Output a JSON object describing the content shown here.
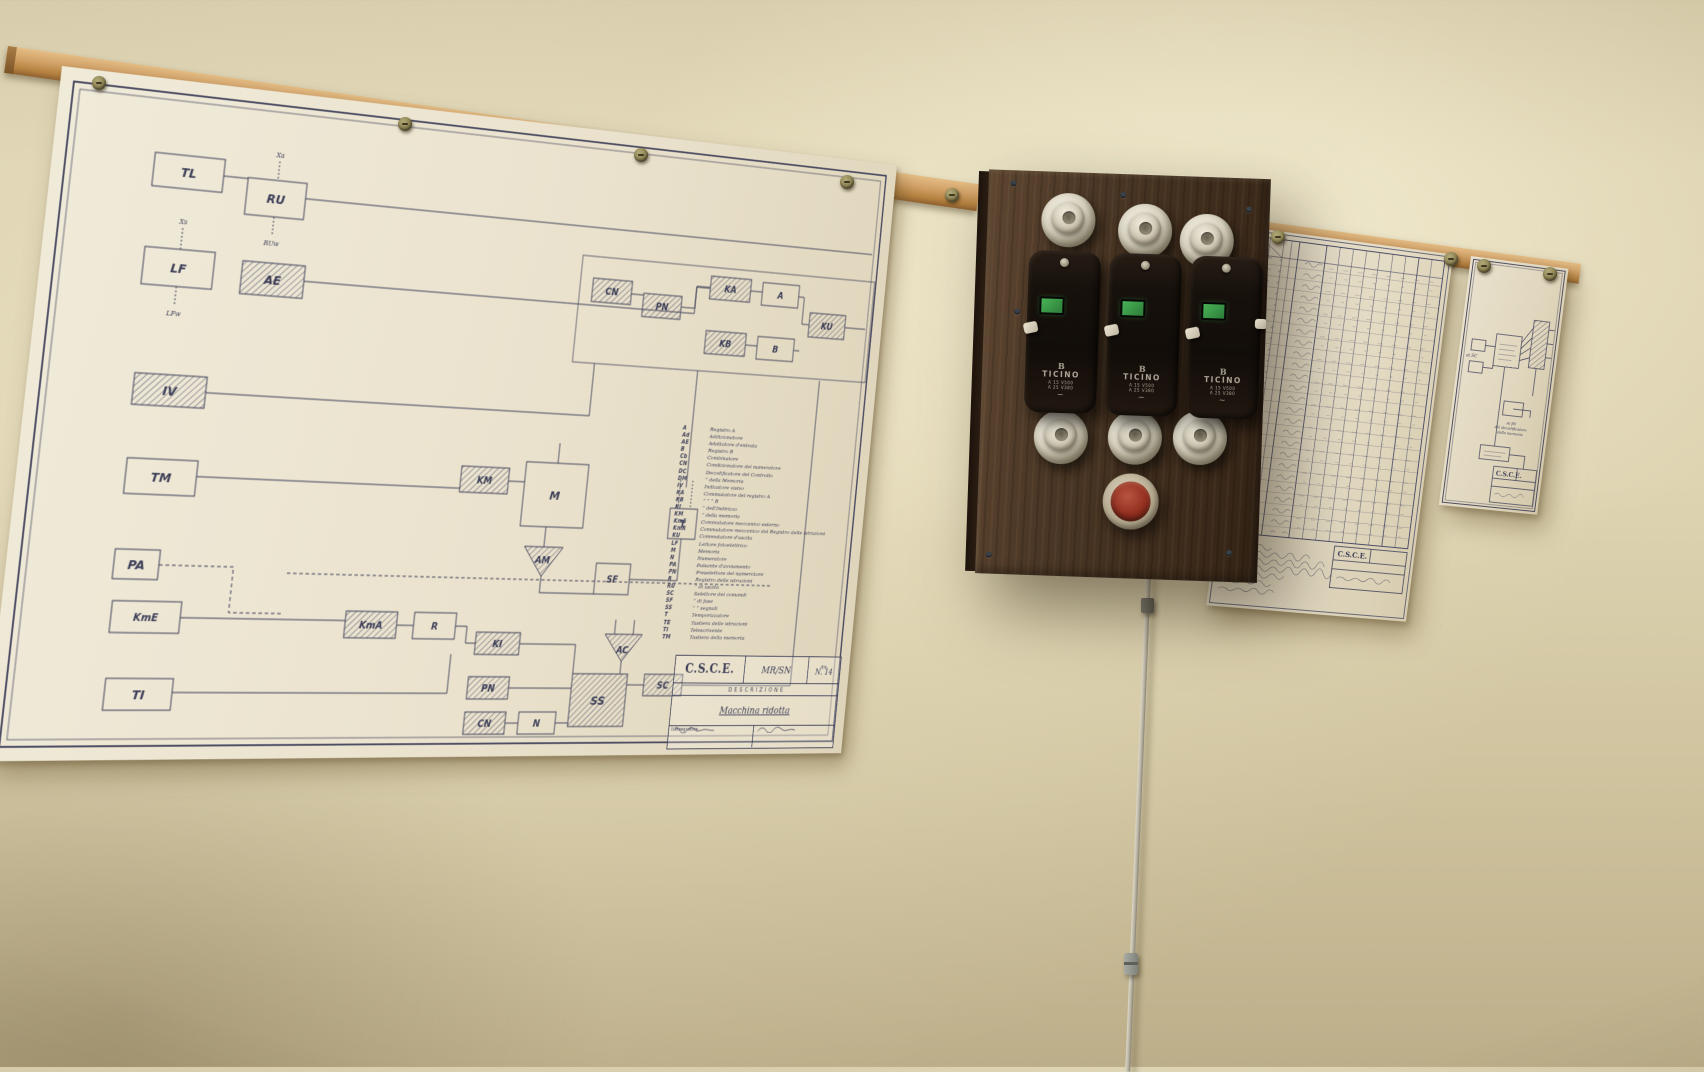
{
  "colors": {
    "wall": "#d8cdab",
    "paper": "#ece5d2",
    "ink": "#3c3e58",
    "rail_wood": "#c99a5f",
    "panel_wood": "#46331f",
    "breaker_body": "#15100c",
    "indicator_green": "#3c9a4c",
    "button_red": "#932f1f",
    "ceramic": "#ddd6c4",
    "cable_grey": "#b8b2a2"
  },
  "left_sheet": {
    "blocks": {
      "tl": "TL",
      "ru": "RU",
      "lf": "LF",
      "ae": "AE",
      "iv": "IV",
      "tm": "TM",
      "pa": "PA",
      "kme": "KmE",
      "ti": "TI",
      "cn1": "CN",
      "pn1": "PN",
      "ka": "KA",
      "a": "A",
      "kb": "KB",
      "b": "B",
      "ku": "KU",
      "km": "KM",
      "m": "M",
      "am": "AM",
      "t": "T",
      "sf": "SF",
      "kma": "KmA",
      "r": "R",
      "ki": "KI",
      "pn2": "PN",
      "cn2": "CN",
      "n": "N",
      "ss": "SS",
      "sc": "SC",
      "ac": "AC"
    },
    "ports": {
      "ru_in": "Xa",
      "ru_out": "RUw",
      "lf_in": "Xs",
      "lf_out": "LFw"
    },
    "legend": [
      {
        "code": "A",
        "desc": "Registro A"
      },
      {
        "code": "Ad",
        "desc": "Addizionatore"
      },
      {
        "code": "AE",
        "desc": "Adattatore d'entrata"
      },
      {
        "code": "B",
        "desc": "Registro B"
      },
      {
        "code": "Cb",
        "desc": "Combinatore"
      },
      {
        "code": "CN",
        "desc": "Condizionatore del numeratore"
      },
      {
        "code": "DC",
        "desc": "Decodificatore del Controllo"
      },
      {
        "code": "DM",
        "desc": "”      della Memoria"
      },
      {
        "code": "IV",
        "desc": "Indicatore visivo"
      },
      {
        "code": "KA",
        "desc": "Commutatore del registro A"
      },
      {
        "code": "KB",
        "desc": "”      ”      ”      B"
      },
      {
        "code": "KI",
        "desc": "”      dell'Indirizzo"
      },
      {
        "code": "KM",
        "desc": "”      della memoria"
      },
      {
        "code": "KmE",
        "desc": "Commutatore meccanico esterno"
      },
      {
        "code": "KmR",
        "desc": "Commutatore meccanico del Registro delle istruzioni"
      },
      {
        "code": "KU",
        "desc": "Commutatore d'uscita"
      },
      {
        "code": "LF",
        "desc": "Lettore fotoelettrico"
      },
      {
        "code": "M",
        "desc": "Memoria"
      },
      {
        "code": "N",
        "desc": "Numeratore"
      },
      {
        "code": "PA",
        "desc": "Pulsante d'avviamento"
      },
      {
        "code": "PN",
        "desc": "Preselettore del numeratore"
      },
      {
        "code": "R",
        "desc": "Registro delle istruzioni"
      },
      {
        "code": "RU",
        "desc": "”      di uscita"
      },
      {
        "code": "SC",
        "desc": "Selettore dei comandi"
      },
      {
        "code": "SF",
        "desc": "”      di fase"
      },
      {
        "code": "SS",
        "desc": "”      ”  segnali"
      },
      {
        "code": "T",
        "desc": "Temporizzatore"
      },
      {
        "code": "TE",
        "desc": "Tastiera delle istruzioni"
      },
      {
        "code": "TI",
        "desc": "Telescrivente"
      },
      {
        "code": "TM",
        "desc": "Tastiera della memoria"
      }
    ],
    "title_block": {
      "org": "C.S.C.E.",
      "code": "MR/SN",
      "descrizione_label": "DESCRIZIONE",
      "description": "Macchina ridotta",
      "drawing_label": "dis.",
      "drawing_number": "N. 14",
      "drafter_label": "Il Disegnatore"
    }
  },
  "panel": {
    "breakers": [
      {
        "logo": "B",
        "brand": "TICINO",
        "rating1": "A 15 V500",
        "rating2": "A 25 V380",
        "phase": "~"
      },
      {
        "logo": "B",
        "brand": "TICINO",
        "rating1": "A 15 V500",
        "rating2": "A 25 V380",
        "phase": "~"
      },
      {
        "logo": "B",
        "brand": "TICINO",
        "rating1": "A 15 V500",
        "rating2": "A 25 V380",
        "phase": "~"
      }
    ]
  },
  "middle_sheet": {
    "title_block": {
      "org": "C.S.C.E."
    }
  },
  "right_sheet": {
    "left_label": "ai SC",
    "caption_lines": [
      "Ai fili",
      "del decodificatore",
      "della memoria"
    ],
    "title_block": {
      "org": "C.S.C.E."
    }
  }
}
